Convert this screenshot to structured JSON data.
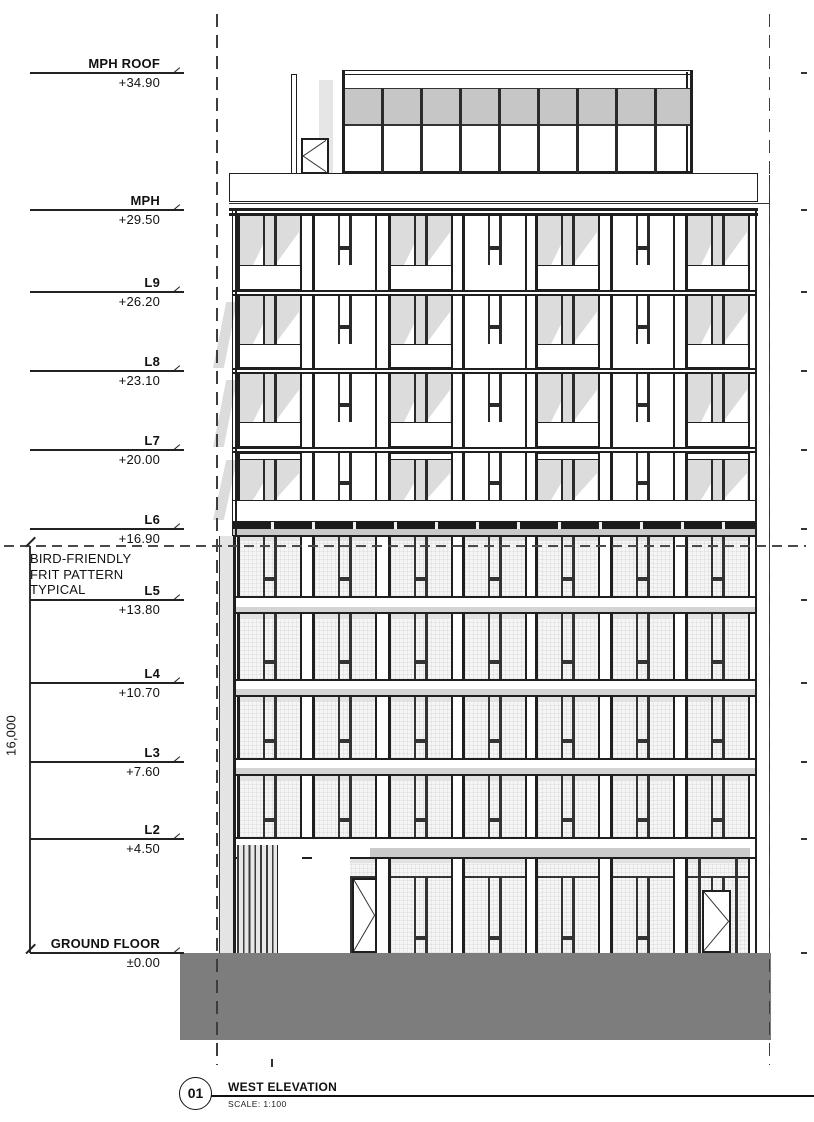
{
  "sheet": {
    "levels": [
      {
        "name": "MPH ROOF",
        "elevation": "+34.90"
      },
      {
        "name": "MPH",
        "elevation": "+29.50"
      },
      {
        "name": "L9",
        "elevation": "+26.20"
      },
      {
        "name": "L8",
        "elevation": "+23.10"
      },
      {
        "name": "L7",
        "elevation": "+20.00"
      },
      {
        "name": "L6",
        "elevation": "+16.90"
      },
      {
        "name": "L5",
        "elevation": "+13.80"
      },
      {
        "name": "L4",
        "elevation": "+10.70"
      },
      {
        "name": "L3",
        "elevation": "+7.60"
      },
      {
        "name": "L2",
        "elevation": "+4.50"
      },
      {
        "name": "GROUND FLOOR",
        "elevation": "±0.00"
      }
    ],
    "note_lines": [
      "BIRD-FRIENDLY",
      "FRIT PATTERN",
      "TYPICAL"
    ],
    "dimension_label": "16,000",
    "title_block": {
      "number": "01",
      "title": "WEST ELEVATION",
      "scale": "SCALE: 1:100"
    },
    "colors": {
      "ground_mass": "#7d7d7d",
      "balcony_shadow": "#dcdcdc",
      "clerestory_band": "#c6c6c6"
    }
  }
}
